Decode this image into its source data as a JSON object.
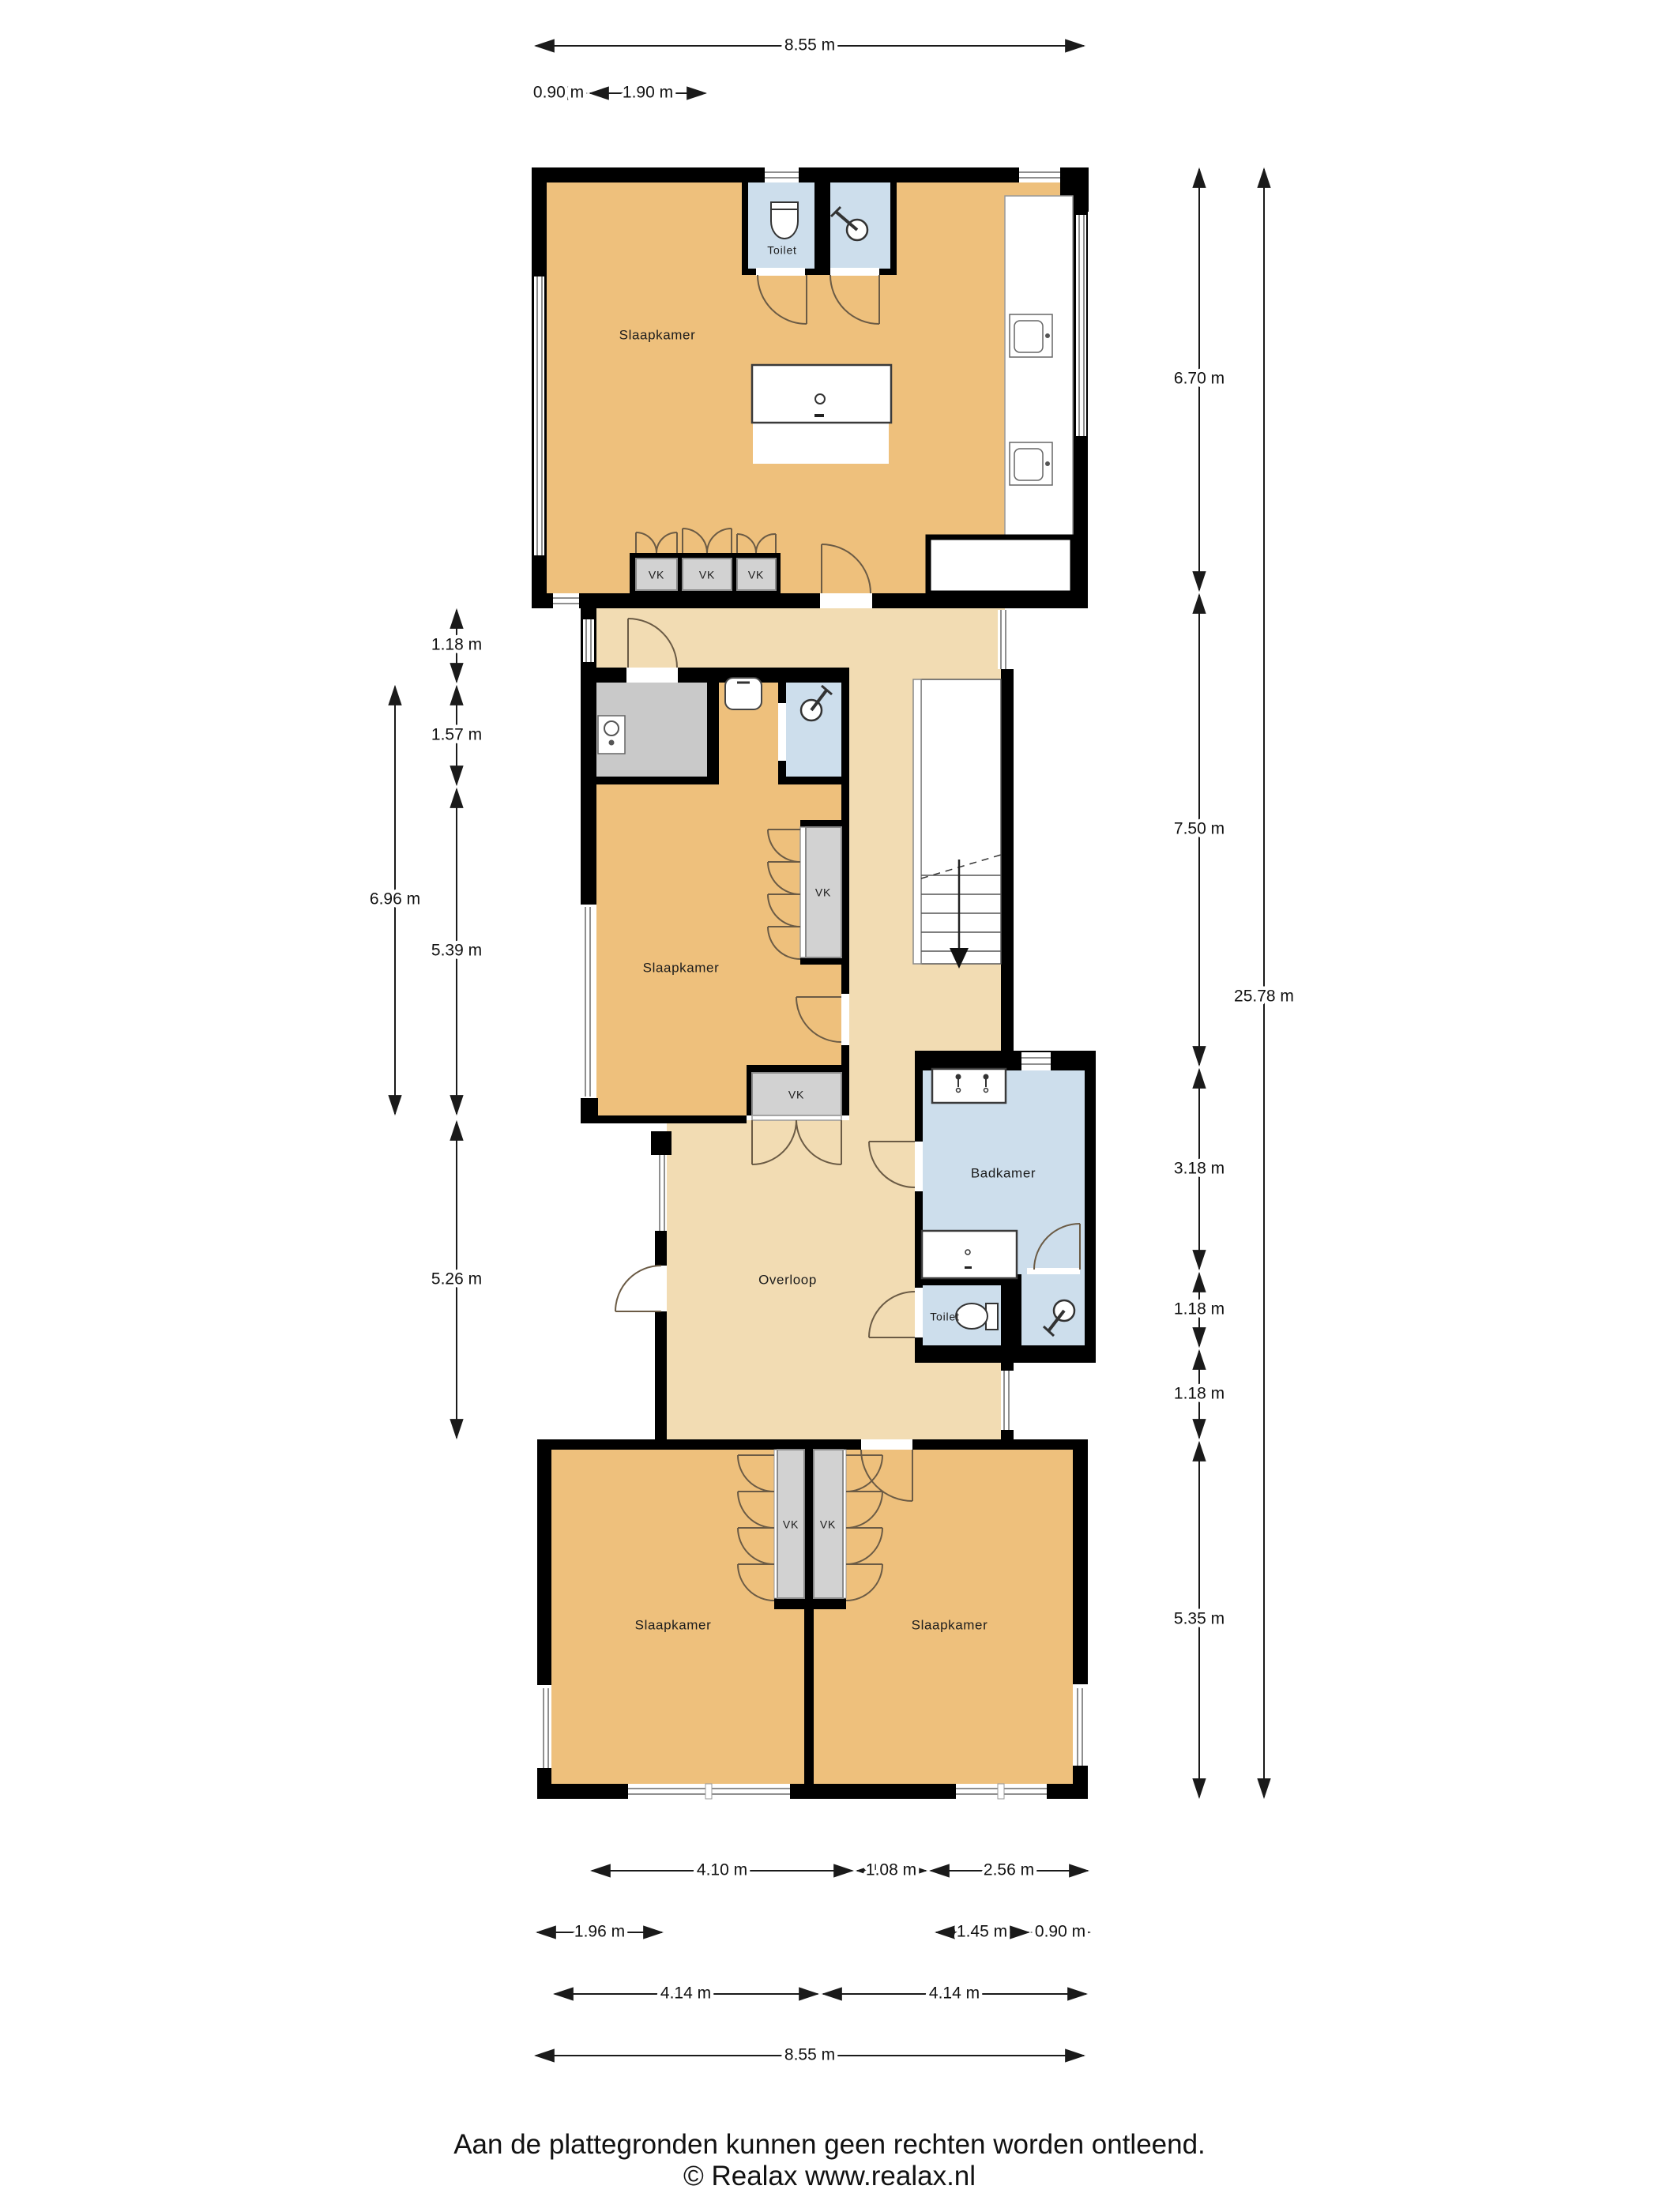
{
  "rooms": {
    "top_bedroom": "Slaapkamer",
    "top_toilet": "Toilet",
    "middle_bedroom": "Slaapkamer",
    "bathroom": "Badkamer",
    "landing": "Overloop",
    "toilet": "Toilet",
    "bottom_left_bedroom": "Slaapkamer",
    "bottom_right_bedroom": "Slaapkamer",
    "closet": "VK"
  },
  "dimensions": {
    "top": [
      {
        "value": "8.55 m"
      },
      {
        "value": "0.90 m"
      },
      {
        "value": "1.90 m"
      }
    ],
    "left": [
      {
        "value": "1.18 m"
      },
      {
        "value": "1.57 m"
      },
      {
        "value": "6.96 m"
      },
      {
        "value": "5.39 m"
      },
      {
        "value": "5.26 m"
      }
    ],
    "right": [
      {
        "value": "6.70 m"
      },
      {
        "value": "7.50 m"
      },
      {
        "value": "25.78 m"
      },
      {
        "value": "3.18 m"
      },
      {
        "value": "1.18 m"
      },
      {
        "value": "1.18 m"
      },
      {
        "value": "5.35 m"
      }
    ],
    "bottom": [
      {
        "value": "4.10 m"
      },
      {
        "value": "1.08 m"
      },
      {
        "value": "2.56 m"
      },
      {
        "value": "1.96 m"
      },
      {
        "value": "1.45 m"
      },
      {
        "value": "0.90 m"
      },
      {
        "value": "4.14 m"
      },
      {
        "value": "4.14 m"
      },
      {
        "value": "8.55 m"
      }
    ]
  },
  "footer": {
    "disclaimer": "Aan de plattegronden kunnen geen rechten worden ontleend.",
    "copyright": "© Realax www.realax.nl"
  },
  "colors": {
    "wall": "#000000",
    "bedroom_fill": "#eec07c",
    "hall_fill": "#f2dcb3",
    "wet_room_fill": "#cddeec",
    "utility_fill": "#c9c9c9",
    "closet_fill": "#d2d2d2"
  }
}
